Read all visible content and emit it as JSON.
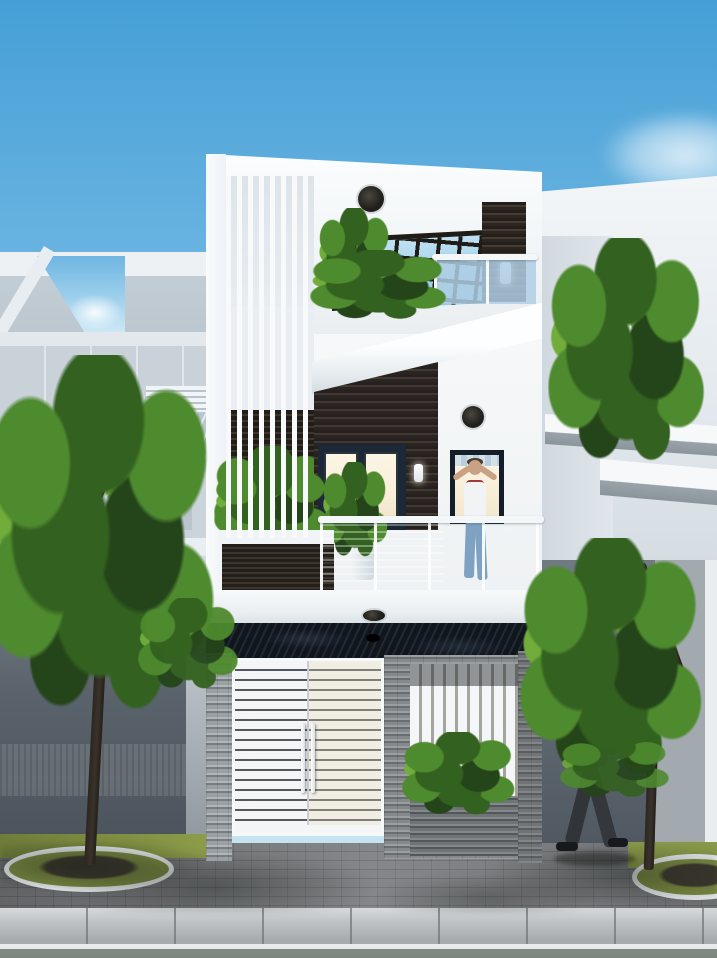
{
  "meta": {
    "description": "3D architectural exterior render of a modern three-storey narrow townhouse with white facade, dark timber slat accents, vertical louver screen, rooftop pergola, glass-railing balconies with plants, white slatted entrance gate, stacked-stone ground walls, street trees, a man relaxing on the balcony and a suited pedestrian walking on the paver sidewalk under a blue sky."
  },
  "palette": {
    "sky-top": "#459fd6",
    "sky-mid": "#7cbfe6",
    "sky-low": "#c6e3f2",
    "wall-white": "#f5f8fa",
    "louver-bar": "#f7f9fa",
    "dark-slat-a": "#211d19",
    "dark-slat-b": "#3e362c",
    "pergola-glass-a": "#bfe0f2",
    "pergola-glass-b": "#8ec9e9",
    "pergola-beam": "#1f1b17",
    "glass-rail": "rgba(175,206,228,0.85)",
    "balcony-glass-a": "rgba(141,174,201,0.88)",
    "balcony-glass-b": "rgba(173,198,218,0.82)",
    "interior-warm": "#f8eed9",
    "frame-dark": "#1c2836",
    "stone-band": "#11161d",
    "stone-mid": "#84898c",
    "gate-white": "#f3f5f7",
    "gate-gap": "rgba(43,48,54,0.8)",
    "paver-light": "#7b7d80",
    "curb-b": "#a7abae",
    "road": "#7b8680",
    "road-line": "#e7e9ea",
    "grass": "#8c9c49",
    "soil": "#3f3b30",
    "leaf-deep": "#24451a",
    "leaf-dark": "#33611f",
    "leaf-mid": "#4e8a2e",
    "leaf-light": "#72ad3c",
    "leaf-bright": "#8cc44e",
    "trunk": "#3a332b",
    "skin": "#c9a284",
    "suit": "#3d4145",
    "jeans": "#7fa2c2"
  },
  "scene": {
    "objects": [
      {
        "name": "sky",
        "label": "clear blue sky with clouds"
      },
      {
        "name": "left-neighbor-house",
        "label": "light gray neighboring house with rooftop frame"
      },
      {
        "name": "right-neighbor-house",
        "label": "white neighboring house with slab canopies"
      },
      {
        "name": "main-house",
        "label": "three-storey modern white townhouse"
      },
      {
        "name": "roof-parapet",
        "label": "white slanted parapet"
      },
      {
        "name": "ceiling-light",
        "label": "round black ceiling downlight"
      },
      {
        "name": "louver-screen",
        "label": "white vertical louver screen"
      },
      {
        "name": "pergola",
        "label": "rooftop timber pergola grid over glass"
      },
      {
        "name": "timber-column",
        "label": "dark timber slat column with wall lamp"
      },
      {
        "name": "roof-terrace-plants",
        "label": "green terrace planting"
      },
      {
        "name": "glass-railing",
        "label": "frameless glass railing with white handrail"
      },
      {
        "name": "planter-slab",
        "label": "white cantilevered planter slab"
      },
      {
        "name": "feature-wall",
        "label": "dark timber slat feature wall"
      },
      {
        "name": "glass-doors",
        "label": "dark framed glass doors with warm interior light"
      },
      {
        "name": "balcony",
        "label": "second floor balcony with blue glass balustrade"
      },
      {
        "name": "balcony-man",
        "label": "man in white t-shirt and jeans on balcony"
      },
      {
        "name": "entrance-gate",
        "label": "white horizontal slat double gate"
      },
      {
        "name": "stone-walls",
        "label": "stacked stone ground floor walls"
      },
      {
        "name": "louver-window",
        "label": "ground floor louvered opening with plants"
      },
      {
        "name": "street-tree-left",
        "label": "large street tree"
      },
      {
        "name": "street-tree-right",
        "label": "street tree by right wall"
      },
      {
        "name": "pedestrian",
        "label": "man in gray suit walking on sidewalk"
      },
      {
        "name": "sidewalk",
        "label": "gray paver sidewalk"
      },
      {
        "name": "curb-and-road",
        "label": "concrete curb and asphalt road"
      }
    ]
  }
}
